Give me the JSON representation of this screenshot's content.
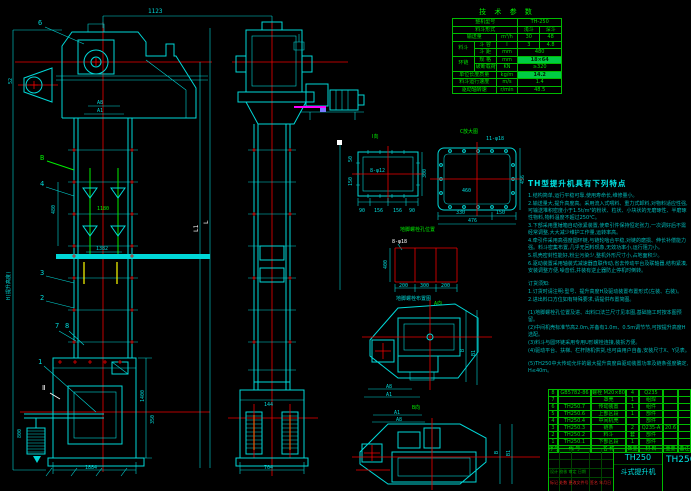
{
  "doc": {
    "type": "CAD assembly drawing",
    "subject": "TH250 bucket elevator general drawing"
  },
  "dims": {
    "top_width": "1123",
    "head_52": "52",
    "head_a8": "A8",
    "head_a1": "A1",
    "balloon_6": "6",
    "balloon_b": "B",
    "balloon_4": "4",
    "balloon_3": "3",
    "balloon_2": "2",
    "balloon_1": "1",
    "balloon_7": "7",
    "balloon_8": "8",
    "chain_pitch": "1180",
    "mid_width": "1382",
    "casing_480": "480",
    "height_label": "H(提升高度)",
    "takeup_800": "800",
    "boot_width": "1884",
    "boot_1400": "1400",
    "boot_350": "350",
    "side_boot_width": "704",
    "side_144": "144",
    "len_l": "L",
    "len_l1": "L1",
    "section_ii": "Ⅱ"
  },
  "view_i": {
    "label": "Ⅰ向",
    "holes": "8-φ12",
    "right": "300",
    "left1": "50",
    "left2": "150",
    "bottom": [
      "90",
      "156",
      "156",
      "90"
    ]
  },
  "view_c": {
    "label": "C放大图",
    "holes": "11-φ18",
    "inner": "460",
    "right": "456",
    "bottom1": "330",
    "bottom2": "150",
    "bottom_total": "476"
  },
  "anchor": {
    "title": "地脚螺栓孔位置",
    "holes": "8-φ18",
    "height": "400",
    "bottom": [
      "200",
      "300",
      "200"
    ],
    "caption": "地脚螺栓布置图"
  },
  "plan": {
    "label": "A向",
    "dim_b": "B",
    "dim_b1": "B1",
    "dim_a8": "A8",
    "dim_a1": "A1"
  },
  "aux": {
    "label": "B向",
    "dim_a1": "A1",
    "dim_a8": "A8",
    "dim_b": "B",
    "dim_b1": "B1"
  },
  "tech_table": {
    "title": "技 术 参 数",
    "rows": {
      "model_label": "整机型号",
      "model_value": "TH-250",
      "bucket_type_label": "料斗形式",
      "bucket_shallow": "浅斗",
      "bucket_deep": "深斗",
      "capacity_label": "输送量",
      "capacity_unit": "m³/h",
      "capacity_v1": "30",
      "capacity_v2": "48",
      "bucket_group": "料斗",
      "vol_label": "斗 容",
      "vol_unit": "l",
      "vol_v1": "3",
      "vol_v2": "4.8",
      "pitch_label": "斗 距",
      "pitch_unit": "mm",
      "pitch_value": "480",
      "chain_group": "环链",
      "spec_label": "规 格",
      "spec_unit": "mm",
      "spec_value": "18×64",
      "break_label": "破断载荷",
      "break_unit": "KN",
      "break_value": "≥320",
      "mass_label": "单位长度质量",
      "mass_unit": "kg/m",
      "mass_value": "14.2",
      "speed_label": "料斗运行速度",
      "speed_unit": "m/s",
      "speed_value": "1.4",
      "rpm_label": "驱动轴转速",
      "rpm_unit": "r/min",
      "rpm_value": "48.5"
    }
  },
  "features": {
    "title": "TH型提升机具有下列特点",
    "lines": [
      "1.结构简单,运行平稳可靠,使用寿命长,维修量小。",
      "2.输送量大,提升高度高。采用流入式喂料、重力式卸料,对物料适应性强,可输送堆积密度小于1.5t/m³的粉状、粒状、小块状的无磨琢性、半磨琢性物料,物料温度不超过250℃。",
      "3.下部采用重锤箱自动张紧装置,使牵引件保持恒定张力,一次调好后不需经常调整,大大减少维护工作量,运转率高。",
      "4.牵引件采用高强度圆环链,与链轮啮合平稳,对链的磨损、伸长补偿能力强。料斗密集布置,几乎无回料现象,无效功率小,运行阻力小。",
      "5.机壳密封性能好,粉尘污染少,整机外形尺寸小,占地面积少。",
      "6.驱动装置采用轴装式减速器直联传动,省去传动平台及联轴器,结构紧凑,安装调整方便,噪音低,并装有逆止器防止停机时倒转。",
      "",
      "订货须知:",
      "1.订货时请注明:型号、提升高度H及驱动装置布置形式(左装、右装)。",
      "2.进出料口方位如有特殊要求,请提供布置简图。",
      "",
      "(1)地脚螺栓孔位置及进、出料口法兰尺寸见本图,基础施工时按本图预留。",
      "(2)中间机壳标准节高2.0m,并备有1.0m、0.5m调节节,可按提升高度H选配。",
      "(3)料斗与圆环链采用专用U形螺栓连接,装拆方便。",
      "(4)驱动平台、扶梯、栏杆随机供货,也可由用户自备,安装尺寸X、Y见表。",
      "",
      "(5)TH250中大传动允许的最大提升高度由驱动装置功率及链条强度确定,H≤40m。"
    ]
  },
  "bom": {
    "headers": [
      "序号",
      "代 号",
      "名 称",
      "数量",
      "材 料",
      "重量",
      "备注"
    ],
    "rows": [
      [
        "8",
        "GB5782-86",
        "螺栓 M20×80",
        "4",
        "Q235",
        "",
        ""
      ],
      [
        "7",
        "",
        "罩壳",
        "1",
        "组焊",
        "",
        ""
      ],
      [
        "6",
        "TH250.7",
        "传动装置",
        "1",
        "组件",
        "",
        ""
      ],
      [
        "5",
        "TH250.6",
        "上部区段",
        "1",
        "部件",
        "",
        ""
      ],
      [
        "4",
        "TH250.4",
        "中间机壳",
        "",
        "部件",
        "",
        ""
      ],
      [
        "3",
        "TH250.3",
        "链条",
        "2",
        "Q235-A",
        "20.6",
        ""
      ],
      [
        "2",
        "TH250.2",
        "料斗",
        "套",
        "部件",
        "",
        ""
      ],
      [
        "1",
        "TH250.1",
        "下部区段",
        "1",
        "部件",
        "",
        ""
      ]
    ]
  },
  "title_block": {
    "model": "TH250",
    "name": "斗式提升机",
    "right_model": "TH250",
    "rev_text": "标记 处数 更改文件号 签名 年月日",
    "staff_text": "设计 校核 审定 日期"
  }
}
